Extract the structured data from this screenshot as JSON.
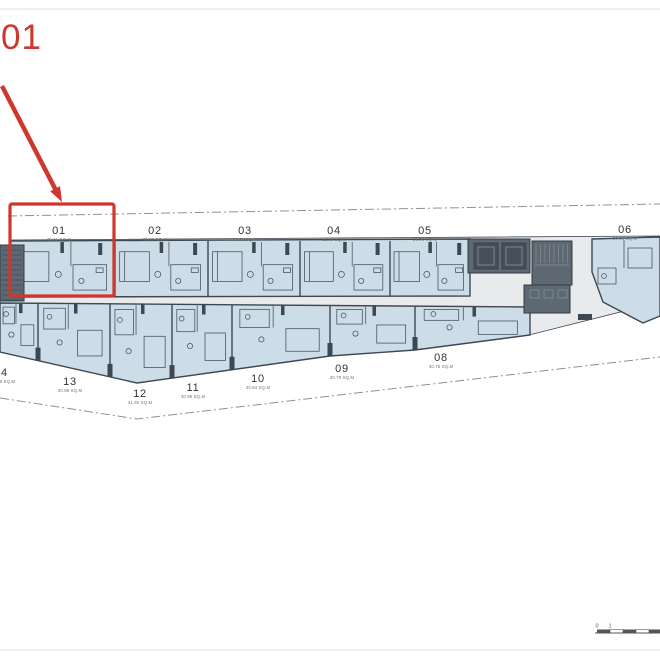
{
  "annotation": {
    "label": "01"
  },
  "scale_bar": {
    "labels": [
      "0",
      "1",
      "5"
    ]
  },
  "floor_plan": {
    "colors": {
      "unit_fill": "#cddde7",
      "wall": "#3d4854",
      "fixture": "#4b5663",
      "plate_fill": "#e9eaeb",
      "core_fill": "#5d6872",
      "core_dark": "#454f59",
      "core_line": "#333c45",
      "boundary": "#909090",
      "divider": "#e4e4e4",
      "accent": "#cf362c",
      "label": "#333333",
      "area_label": "#707070",
      "scale": "#555555"
    },
    "units": [
      {
        "id": "01",
        "area": "39.61 SQ.M",
        "band": "top",
        "x0": 10,
        "x1": 115,
        "label_x": 59,
        "label_y": 234
      },
      {
        "id": "02",
        "area": "31.38 SQ.M",
        "band": "top",
        "x0": 115,
        "x1": 208,
        "label_x": 155,
        "label_y": 234
      },
      {
        "id": "03",
        "area": "31.61 SQ.M",
        "band": "top",
        "x0": 208,
        "x1": 300,
        "label_x": 245,
        "label_y": 234
      },
      {
        "id": "04",
        "area": "31.38 SQ.M",
        "band": "top",
        "x0": 300,
        "x1": 390,
        "label_x": 334,
        "label_y": 234
      },
      {
        "id": "05",
        "area": "31.38 SQ.M",
        "band": "top",
        "x0": 390,
        "x1": 470,
        "label_x": 425,
        "label_y": 234
      },
      {
        "id": "06",
        "area": "30.01 SQ.M",
        "band": "right",
        "x0": 592,
        "x1": 660,
        "label_x": 625,
        "label_y": 233
      },
      {
        "id": "08",
        "area": "30.78 SQ.M",
        "band": "bottom",
        "x0": 415,
        "x1": 530,
        "label_x": 441,
        "label_y": 361
      },
      {
        "id": "09",
        "area": "30.78 SQ.M",
        "band": "bottom",
        "x0": 330,
        "x1": 415,
        "label_x": 342,
        "label_y": 372
      },
      {
        "id": "10",
        "area": "30.84 SQ.M",
        "band": "bottom",
        "x0": 232,
        "x1": 330,
        "label_x": 258,
        "label_y": 382
      },
      {
        "id": "11",
        "area": "30.98 SQ.M",
        "band": "bottom",
        "x0": 172,
        "x1": 232,
        "label_x": 193,
        "label_y": 391
      },
      {
        "id": "12",
        "area": "31.90 SQ.M",
        "band": "bottom",
        "x0": 110,
        "x1": 172,
        "label_x": 140,
        "label_y": 397
      },
      {
        "id": "13",
        "area": "30.98 SQ.M",
        "band": "bottom",
        "x0": 38,
        "x1": 110,
        "label_x": 70,
        "label_y": 385
      },
      {
        "id": "14",
        "area": "30.98 SQ.M",
        "band": "bottom",
        "x0": 0,
        "x1": 38,
        "label_x": 1,
        "label_y": 376
      }
    ],
    "geo": {
      "plate": "10,240 660,236 660,302 533,334 415,350 330,356 137,383 0,352 0,296 10,296",
      "top_band": "10,241 470,239 470,296 10,297",
      "bottom_band": "0,303 530,307 530,335 415,350 330,356 137,383 0,352",
      "unit06": "592,239 660,237 660,316 643,323 603,302 592,272",
      "bottom_edge": [
        [
          0,
          352
        ],
        [
          137,
          383
        ],
        [
          330,
          356
        ],
        [
          415,
          350
        ],
        [
          530,
          335
        ]
      ],
      "bottom_top": [
        [
          0,
          303
        ],
        [
          530,
          307
        ]
      ],
      "dash_top": [
        [
          8,
          216
        ],
        [
          660,
          204
        ]
      ],
      "dash_bottom": [
        [
          0,
          398
        ],
        [
          137,
          419
        ],
        [
          660,
          357
        ]
      ],
      "separators_top": [
        115,
        208,
        300,
        390
      ],
      "separators_bottom": [
        38,
        110,
        172,
        232,
        330,
        415
      ],
      "dividers_y": [
        9,
        650
      ],
      "box": [
        10,
        204,
        104,
        92
      ],
      "arrow": {
        "from": [
          2,
          86
        ],
        "to": [
          62,
          202
        ]
      },
      "core": {
        "stair_left": [
          0,
          245,
          24,
          56
        ],
        "elev": [
          468,
          239,
          62,
          34
        ],
        "shafts": [
          [
            474,
            243,
            24,
            26
          ],
          [
            502,
            243,
            24,
            26
          ]
        ],
        "stair": [
          532,
          241,
          40,
          44
        ],
        "service": [
          524,
          285,
          46,
          28
        ],
        "door_bar": [
          578,
          314,
          14,
          6
        ]
      },
      "scale": {
        "x": 597,
        "y": 632,
        "seg": 13
      }
    }
  }
}
